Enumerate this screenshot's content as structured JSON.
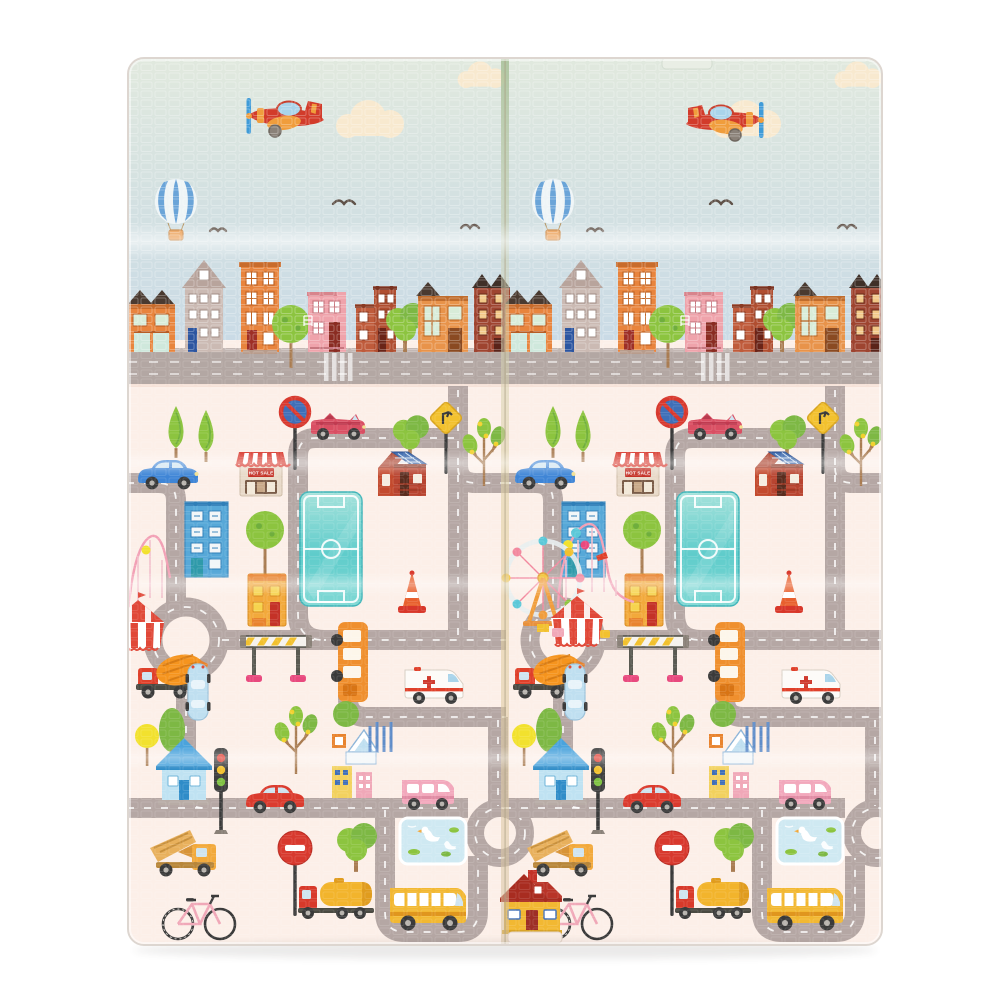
{
  "image_type": "product-photo",
  "subject": "foldable baby XPE play mat, city road-map print, shown folded flat with a center fold crease and horizontal fold bands",
  "shop_sign": {
    "text": "HOT SALE"
  },
  "panels": {
    "count": 2,
    "left": {
      "airplane_direction": "left"
    },
    "right": {
      "airplane_direction": "right"
    }
  },
  "scene": {
    "sky": [
      "red toy airplane x2",
      "cream clouds",
      "blue-white striped hot air balloon x2",
      "flying bird silhouettes x3 per panel"
    ],
    "skyline": [
      "orange storefront with dark gable roofs",
      "tan townhouse with blue door",
      "tall orange apartment block",
      "round street trees",
      "pink house",
      "red-brick duplex",
      "orange corner house",
      "dark brick building"
    ],
    "ground_landmarks": [
      "teal soccer field x2",
      "ferris wheel at center fold",
      "circus tent",
      "roller coaster arcs",
      "roundabout x2 per panel",
      "duck pond x2",
      "zebra crossing"
    ],
    "vehicles": [
      "pink convertible",
      "blue hatchback",
      "cement mixer truck",
      "light-blue top-view car",
      "orange shuttle bus",
      "ambulance",
      "red car",
      "pink minivan",
      "dump truck",
      "fuel tanker truck",
      "yellow school bus",
      "pink bicycle"
    ],
    "street_props": [
      "no-stopping sign",
      "no-entry sign",
      "warning diamond sign",
      "traffic light",
      "striped barrier gate",
      "traffic cone",
      "conifer trees",
      "lemon trees",
      "round trees",
      "balloon tree"
    ],
    "buildings_ground": [
      "HOT SALE awning shop",
      "red house with solar roof",
      "blue office block",
      "yellow kiosk",
      "small blue house",
      "white house with crosswalk fence",
      "yellow house with red roof"
    ]
  },
  "palette": {
    "mat_cream": "#fcefe8",
    "cloud": "#f8e9cf",
    "road": "#b5a7a4",
    "skyline_road": "#b3a7a3",
    "bird": "#5f5148",
    "plane_red": "#d23b2a",
    "plane_orange": "#f09d3c",
    "canopy_blue": "#a9d4ea",
    "prop_blue": "#3f9bd8",
    "balloon_blue": "#6aa4d8",
    "field_teal": "#5fcccb",
    "tree_green": "#8cc43f",
    "tree_dark": "#6fae3d",
    "trunk_brown": "#a97c52",
    "awning_red": "#d8392e",
    "solar_blue": "#2f5fa8",
    "cone_orange": "#e8602e",
    "truck_orange": "#f5941e",
    "truck_red": "#df402a",
    "car_blue": "#3f85d6",
    "car_red": "#db3b2e",
    "van_pink": "#f2a8bc",
    "bus_yellow": "#f2b832",
    "pond_blue": "#cfe9f2",
    "spoke_pink": "#f2889e",
    "coaster_pink": "#f2a0b5",
    "tent_red": "#e04838",
    "sky_top": "#e1e9de",
    "sky_bottom": "#c9dae6",
    "fold_green": "#a3bd93",
    "fold_gold": "#e3d0a0"
  }
}
